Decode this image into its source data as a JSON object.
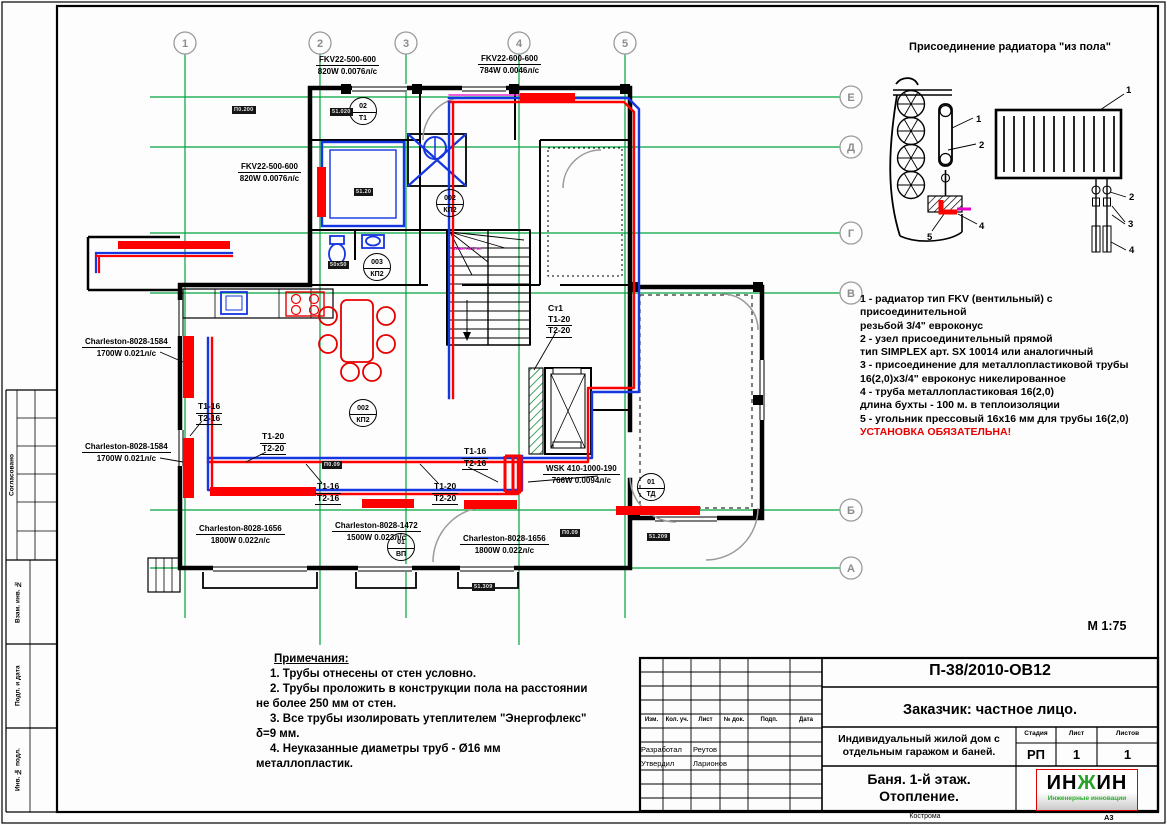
{
  "axes": {
    "columns": [
      "1",
      "2",
      "3",
      "4",
      "5"
    ],
    "rows": [
      "Е",
      "Д",
      "Г",
      "В",
      "Б",
      "А"
    ]
  },
  "detail": {
    "title": "Присоединение радиатора \"из пола\"",
    "left_callouts": [
      "1",
      "2",
      "4",
      "5"
    ],
    "right_callouts": [
      "1",
      "2",
      "3",
      "4"
    ]
  },
  "legend": {
    "lines": [
      "1 - радиатор тип FKV (вентильный) с присоединительной",
      "резьбой 3/4\" евроконус",
      "2 - узел присоединительный прямой",
      "тип SIMPLEX  арт. SX 10014 или аналогичный",
      "3 - присоединение для металлопластиковой трубы",
      "16(2,0)х3/4\" евроконус никелированное",
      "4 - труба металлопластиковая 16(2,0)",
      "длина бухты - 100 м. в теплоизоляции",
      "5 - угольник прессовый 16х16 мм для трубы 16(2,0)"
    ],
    "warning": "УСТАНОВКА ОБЯЗАТЕЛЬНА!"
  },
  "scale": "М 1:75",
  "notes": {
    "title": "Примечания:",
    "lines": [
      "1. Трубы отнесены от стен условно.",
      "2. Трубы проложить в конструкции  пола на расстоянии",
      "не более 250 мм от стен.",
      "3. Все трубы изолировать утеплителем \"Энергофлекс\"",
      "δ=9 мм.",
      "4. Неуказанные диаметры труб - Ø16 мм",
      "металлопластик."
    ]
  },
  "plan": {
    "stair_note": "Вых. на 2 эт.",
    "radiator_labels": [
      {
        "name": "FKV22-500-600",
        "spec": "820W 0.0076л/с"
      },
      {
        "name": "FKV22-600-600",
        "spec": "784W 0.0046л/с"
      },
      {
        "name": "FKV22-500-600",
        "spec": "820W 0.0076л/с"
      },
      {
        "name": "Charleston-8028-1584",
        "spec": "1700W 0.021л/с"
      },
      {
        "name": "Charleston-8028-1584",
        "spec": "1700W 0.021л/с"
      },
      {
        "name": "Charleston-8028-1656",
        "spec": "1800W 0.022л/с"
      },
      {
        "name": "Charleston-8028-1472",
        "spec": "1500W 0.023л/с"
      },
      {
        "name": "Charleston-8028-1656",
        "spec": "1800W 0.022л/с"
      },
      {
        "name": "WSK 410-1000-190",
        "spec": "766W 0.0094л/с"
      }
    ],
    "pipe_labels": [
      {
        "s": "Т1-16",
        "r": "Т2-16"
      },
      {
        "s": "Т1-20",
        "r": "Т2-20"
      },
      {
        "s": "Т1-16",
        "r": "Т2-16"
      },
      {
        "s": "Т1-20",
        "r": "Т2-20"
      },
      {
        "s": "Т1-16",
        "r": "Т2-16"
      }
    ],
    "riser": {
      "name": "Ст1",
      "supply": "Т1-20",
      "return": "Т2-20"
    },
    "marks": [
      {
        "top": "02",
        "bottom": "Т1"
      },
      {
        "top": "002",
        "bottom": "КП2"
      },
      {
        "top": "003",
        "bottom": "КП2"
      },
      {
        "top": "002",
        "bottom": "КП2"
      },
      {
        "top": "01",
        "bottom": "ВП"
      },
      {
        "top": "01",
        "bottom": "ТД"
      }
    ],
    "room_tags": [
      "П0.200",
      "51.020",
      "51.20",
      "50x50",
      "П0.09",
      "П0.09",
      "51.209",
      "51.309"
    ]
  },
  "titleblock": {
    "doc_number": "П-38/2010-ОВ12",
    "customer": "Заказчик: частное лицо.",
    "project": "Индивидуальный жилой дом с отдельным гаражом и баней.",
    "sheet_title_1": "Баня. 1-й этаж.",
    "sheet_title_2": "Отопление.",
    "stage_label": "Стадия",
    "sheet_label": "Лист",
    "sheets_label": "Листов",
    "stage": "РП",
    "sheet": "1",
    "sheets": "1",
    "columns": [
      "Изм.",
      "Кол. уч.",
      "Лист",
      "№ док.",
      "Подп.",
      "Дата"
    ],
    "developed_label": "Разработал",
    "developed_by": "Реутов",
    "approved_label": "Утвердил",
    "approved_by": "Ларионов",
    "city": "Кострома",
    "format": "А3",
    "logo": {
      "p1": "ИН",
      "p2": "Ж",
      "p3": "ИН",
      "subtitle": "Инженерные инновации"
    }
  },
  "margin": {
    "approved": "Согласовано",
    "vzam": "Взам. инв. №",
    "podp": "Подп. и дата",
    "inv": "Инв. № подл."
  }
}
